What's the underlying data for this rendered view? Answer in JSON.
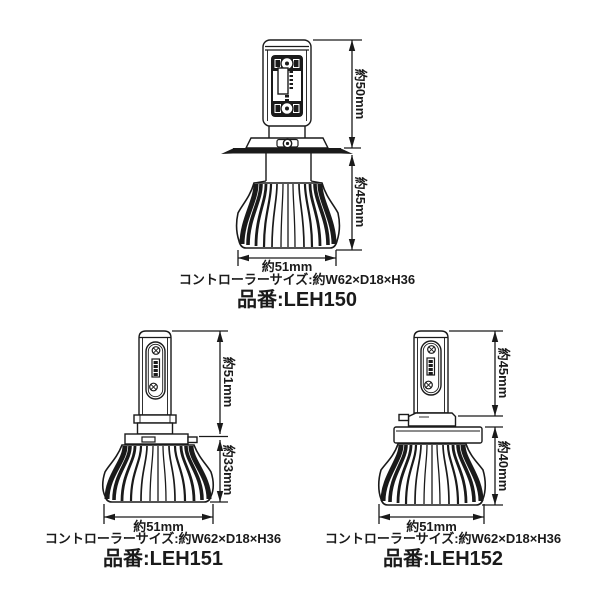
{
  "diagram": {
    "background": "#ffffff",
    "line_color": "#1a1a1a",
    "products": [
      {
        "part_label": "品番:",
        "part_number": "LEH150",
        "controller_size": "コントローラーサイズ:約W62×D18×H36",
        "dim_upper": "約50mm",
        "dim_lower": "約45mm",
        "dim_width": "約51mm"
      },
      {
        "part_label": "品番:",
        "part_number": "LEH151",
        "controller_size": "コントローラーサイズ:約W62×D18×H36",
        "dim_upper": "約51mm",
        "dim_lower": "約33mm",
        "dim_width": "約51mm"
      },
      {
        "part_label": "品番:",
        "part_number": "LEH152",
        "controller_size": "コントローラーサイズ:約W62×D18×H36",
        "dim_upper": "約45mm",
        "dim_lower": "約40mm",
        "dim_width": "約51mm"
      }
    ]
  }
}
